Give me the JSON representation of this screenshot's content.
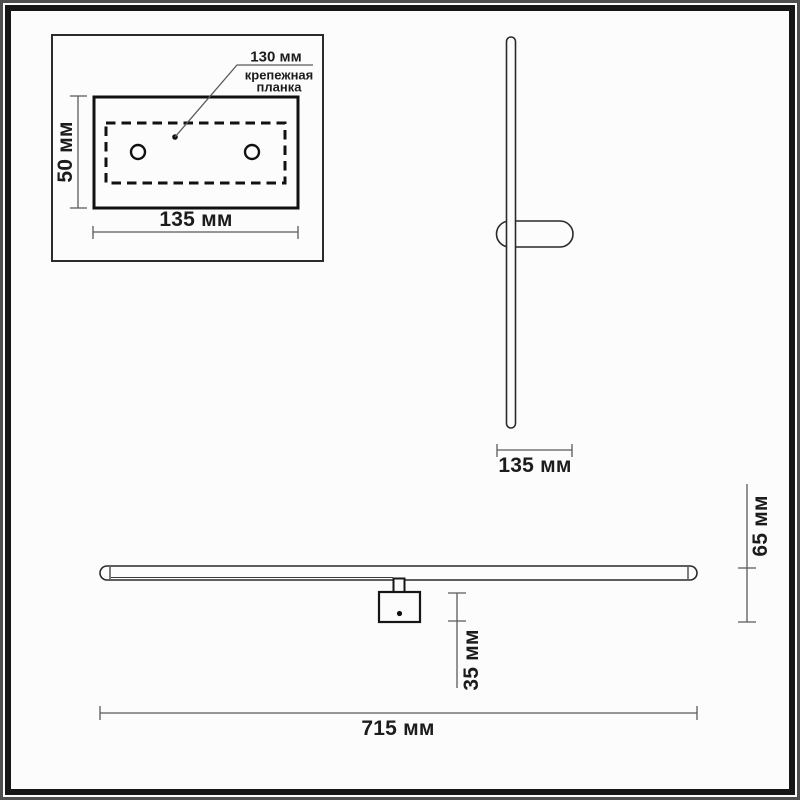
{
  "drawing": {
    "kind": "wall-lamp dimensional drawing",
    "labels": {
      "plate_detail": {
        "hole_spacing": "130 мм",
        "bracket_line1": "крепежная",
        "bracket_line2": "планка",
        "height": "50 мм",
        "width": "135 мм"
      },
      "side_view": {
        "depth": "135 мм"
      },
      "front_view": {
        "length": "715 мм",
        "driver_height": "35 мм",
        "total_depth": "65 мм"
      }
    },
    "colors": {
      "background": "#fcfcfc",
      "frame_outer": "#4f4f4f",
      "frame_inner": "#161616",
      "outline": "#2a2a2a",
      "heavy_outline": "#111111",
      "dimension_line": "#5a5a5a",
      "text": "#1c1c1c"
    }
  }
}
